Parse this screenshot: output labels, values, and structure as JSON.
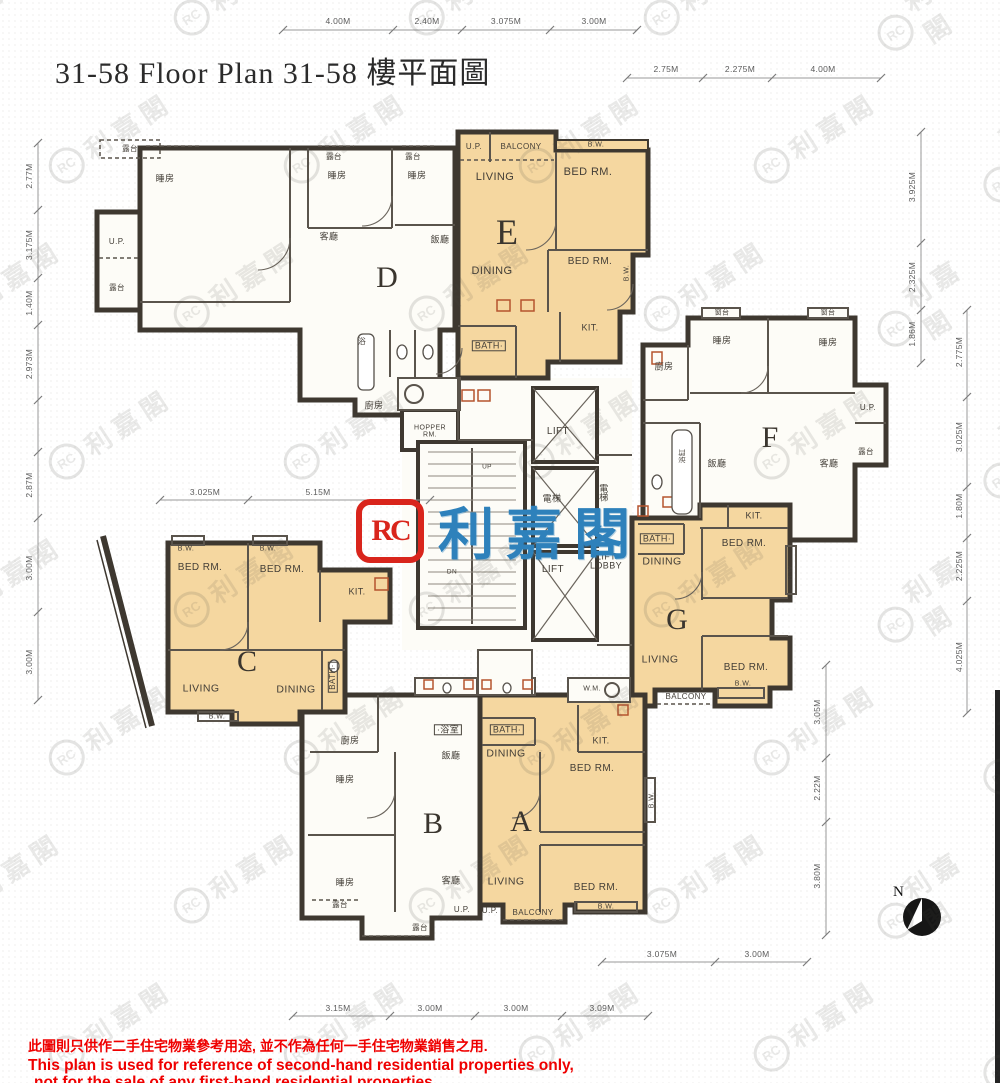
{
  "title": "31-58 Floor Plan 31-58 樓平面圖",
  "logo": {
    "emblem": "RC",
    "name": "利嘉閣"
  },
  "watermark": {
    "emblem": "RC",
    "text": "利嘉閣"
  },
  "north": {
    "label": "N"
  },
  "units": [
    {
      "letter": "D",
      "x": 387,
      "y": 278
    },
    {
      "letter": "E",
      "x": 507,
      "y": 232,
      "s": 36
    },
    {
      "letter": "F",
      "x": 770,
      "y": 438
    },
    {
      "letter": "G",
      "x": 677,
      "y": 620
    },
    {
      "letter": "C",
      "x": 247,
      "y": 662
    },
    {
      "letter": "B",
      "x": 433,
      "y": 824
    },
    {
      "letter": "A",
      "x": 521,
      "y": 822
    }
  ],
  "rooms": [
    {
      "t": "U.P.",
      "x": 474,
      "y": 147,
      "s": 8
    },
    {
      "t": "BALCONY",
      "x": 521,
      "y": 147,
      "s": 8
    },
    {
      "t": "LIVING",
      "x": 495,
      "y": 178,
      "s": 11
    },
    {
      "t": "B.W.",
      "x": 596,
      "y": 145,
      "s": 7
    },
    {
      "t": "BED RM.",
      "x": 588,
      "y": 173,
      "s": 11
    },
    {
      "t": "DINING",
      "x": 492,
      "y": 272,
      "s": 11
    },
    {
      "t": "BED RM.",
      "x": 590,
      "y": 262,
      "s": 10
    },
    {
      "t": "B.W.",
      "x": 627,
      "y": 273,
      "s": 7,
      "r": 1
    },
    {
      "t": "BATH·",
      "x": 489,
      "y": 346,
      "s": 9,
      "box": 1
    },
    {
      "t": "KIT.",
      "x": 590,
      "y": 328,
      "s": 9
    },
    {
      "t": "露台",
      "x": 130,
      "y": 149,
      "s": 7.5
    },
    {
      "t": "睡房",
      "x": 165,
      "y": 179,
      "s": 9
    },
    {
      "t": "露台",
      "x": 334,
      "y": 157,
      "s": 7.5
    },
    {
      "t": "睡房",
      "x": 337,
      "y": 176,
      "s": 9
    },
    {
      "t": "露台",
      "x": 413,
      "y": 157,
      "s": 7.5
    },
    {
      "t": "睡房",
      "x": 417,
      "y": 176,
      "s": 9
    },
    {
      "t": "客廳",
      "x": 329,
      "y": 237,
      "s": 9
    },
    {
      "t": "飯廳",
      "x": 440,
      "y": 240,
      "s": 9
    },
    {
      "t": "U.P.",
      "x": 117,
      "y": 242,
      "s": 8
    },
    {
      "t": "露台",
      "x": 117,
      "y": 288,
      "s": 7.5
    },
    {
      "t": "浴",
      "x": 362,
      "y": 342,
      "s": 8
    },
    {
      "t": "廚房",
      "x": 374,
      "y": 406,
      "s": 9
    },
    {
      "t": "HOPPER RM.",
      "x": 430,
      "y": 432,
      "s": 7,
      "w": 48
    },
    {
      "t": "LIFT",
      "x": 558,
      "y": 432,
      "s": 10
    },
    {
      "t": "電梯",
      "x": 552,
      "y": 499,
      "s": 9
    },
    {
      "t": "電梯",
      "x": 604,
      "y": 494,
      "s": 9,
      "w": 13
    },
    {
      "t": "LIFT",
      "x": 553,
      "y": 570,
      "s": 10
    },
    {
      "t": "LIFT LOBBY",
      "x": 606,
      "y": 562,
      "s": 9,
      "w": 44
    },
    {
      "t": "UP",
      "x": 487,
      "y": 468,
      "s": 6.5
    },
    {
      "t": "DN",
      "x": 452,
      "y": 573,
      "s": 6.5
    },
    {
      "t": "窗台",
      "x": 722,
      "y": 313,
      "s": 7
    },
    {
      "t": "睡房",
      "x": 722,
      "y": 341,
      "s": 9
    },
    {
      "t": "窗台",
      "x": 828,
      "y": 313,
      "s": 7
    },
    {
      "t": "睡房",
      "x": 828,
      "y": 343,
      "s": 9
    },
    {
      "t": "廚房",
      "x": 664,
      "y": 367,
      "s": 9
    },
    {
      "t": "飯廳",
      "x": 717,
      "y": 464,
      "s": 9
    },
    {
      "t": "客廳",
      "x": 829,
      "y": 464,
      "s": 9
    },
    {
      "t": "U.P.",
      "x": 868,
      "y": 408,
      "s": 8
    },
    {
      "t": "露台",
      "x": 866,
      "y": 452,
      "s": 7.5
    },
    {
      "t": "浴缸",
      "x": 683,
      "y": 456,
      "s": 7,
      "r": 1
    },
    {
      "t": "KIT.",
      "x": 754,
      "y": 516,
      "s": 9
    },
    {
      "t": "BATH·",
      "x": 657,
      "y": 539,
      "s": 9,
      "box": 1
    },
    {
      "t": "DINING",
      "x": 662,
      "y": 562,
      "s": 10.5
    },
    {
      "t": "BED RM.",
      "x": 744,
      "y": 544,
      "s": 10
    },
    {
      "t": "B.W.",
      "x": 791,
      "y": 572,
      "s": 7,
      "r": 1
    },
    {
      "t": "LIVING",
      "x": 660,
      "y": 660,
      "s": 10.5
    },
    {
      "t": "BED RM.",
      "x": 746,
      "y": 668,
      "s": 10
    },
    {
      "t": "B.W.",
      "x": 743,
      "y": 684,
      "s": 7
    },
    {
      "t": "BALCONY",
      "x": 686,
      "y": 697,
      "s": 8
    },
    {
      "t": "B.W.",
      "x": 186,
      "y": 549,
      "s": 7
    },
    {
      "t": "B.W.",
      "x": 268,
      "y": 549,
      "s": 7
    },
    {
      "t": "BED RM.",
      "x": 200,
      "y": 568,
      "s": 10
    },
    {
      "t": "BED RM.",
      "x": 282,
      "y": 570,
      "s": 10
    },
    {
      "t": "KIT.",
      "x": 357,
      "y": 592,
      "s": 9
    },
    {
      "t": "LIVING",
      "x": 201,
      "y": 689,
      "s": 10.5
    },
    {
      "t": "DINING",
      "x": 296,
      "y": 690,
      "s": 10.5
    },
    {
      "t": "BATH·",
      "x": 333,
      "y": 677,
      "s": 8,
      "r": 1,
      "box": 1
    },
    {
      "t": "B.W.",
      "x": 217,
      "y": 717,
      "s": 7
    },
    {
      "t": "·浴室",
      "x": 448,
      "y": 730,
      "s": 9,
      "box": 1
    },
    {
      "t": "廚房",
      "x": 350,
      "y": 741,
      "s": 9
    },
    {
      "t": "睡房",
      "x": 345,
      "y": 780,
      "s": 9
    },
    {
      "t": "飯廳",
      "x": 451,
      "y": 756,
      "s": 9
    },
    {
      "t": "睡房",
      "x": 345,
      "y": 883,
      "s": 9
    },
    {
      "t": "客廳",
      "x": 451,
      "y": 881,
      "s": 9
    },
    {
      "t": "露台",
      "x": 340,
      "y": 905,
      "s": 7.5
    },
    {
      "t": "露台",
      "x": 420,
      "y": 928,
      "s": 7.5
    },
    {
      "t": "U.P.",
      "x": 462,
      "y": 910,
      "s": 8
    },
    {
      "t": "W.M.",
      "x": 592,
      "y": 689,
      "s": 7
    },
    {
      "t": "BATH·",
      "x": 507,
      "y": 730,
      "s": 9,
      "box": 1
    },
    {
      "t": "DINING",
      "x": 506,
      "y": 754,
      "s": 10.5
    },
    {
      "t": "KIT.",
      "x": 601,
      "y": 741,
      "s": 9
    },
    {
      "t": "BED RM.",
      "x": 592,
      "y": 769,
      "s": 10
    },
    {
      "t": "B.W.",
      "x": 652,
      "y": 800,
      "s": 7,
      "r": 1
    },
    {
      "t": "LIVING",
      "x": 506,
      "y": 882,
      "s": 10.5
    },
    {
      "t": "BED RM.",
      "x": 596,
      "y": 888,
      "s": 10
    },
    {
      "t": "B.W.",
      "x": 606,
      "y": 907,
      "s": 7
    },
    {
      "t": "U.P.",
      "x": 490,
      "y": 911,
      "s": 8
    },
    {
      "t": "BALCONY",
      "x": 533,
      "y": 913,
      "s": 8
    }
  ],
  "dims": [
    {
      "t": "4.00M",
      "x": 338,
      "y": 21
    },
    {
      "t": "2.40M",
      "x": 427,
      "y": 21
    },
    {
      "t": "3.075M",
      "x": 506,
      "y": 21
    },
    {
      "t": "3.00M",
      "x": 594,
      "y": 21
    },
    {
      "t": "2.75M",
      "x": 666,
      "y": 69
    },
    {
      "t": "2.275M",
      "x": 740,
      "y": 69
    },
    {
      "t": "4.00M",
      "x": 823,
      "y": 69
    },
    {
      "t": "3.925M",
      "x": 912,
      "y": 187,
      "r": 1
    },
    {
      "t": "2.325M",
      "x": 912,
      "y": 277,
      "r": 1
    },
    {
      "t": "1.86M",
      "x": 912,
      "y": 334,
      "r": 1
    },
    {
      "t": "2.775M",
      "x": 959,
      "y": 352,
      "r": 1
    },
    {
      "t": "3.025M",
      "x": 959,
      "y": 437,
      "r": 1
    },
    {
      "t": "1.80M",
      "x": 959,
      "y": 506,
      "r": 1
    },
    {
      "t": "2.225M",
      "x": 959,
      "y": 566,
      "r": 1
    },
    {
      "t": "4.025M",
      "x": 959,
      "y": 657,
      "r": 1
    },
    {
      "t": "3.05M",
      "x": 817,
      "y": 712,
      "r": 1
    },
    {
      "t": "2.22M",
      "x": 817,
      "y": 788,
      "r": 1
    },
    {
      "t": "3.80M",
      "x": 817,
      "y": 876,
      "r": 1
    },
    {
      "t": "2.77M",
      "x": 29,
      "y": 176,
      "r": 1
    },
    {
      "t": "3.175M",
      "x": 29,
      "y": 245,
      "r": 1
    },
    {
      "t": "1.40M",
      "x": 29,
      "y": 303,
      "r": 1
    },
    {
      "t": "2.973M",
      "x": 29,
      "y": 364,
      "r": 1
    },
    {
      "t": "2.87M",
      "x": 29,
      "y": 485,
      "r": 1
    },
    {
      "t": "3.00M",
      "x": 29,
      "y": 568,
      "r": 1
    },
    {
      "t": "3.00M",
      "x": 29,
      "y": 662,
      "r": 1
    },
    {
      "t": "3.025M",
      "x": 205,
      "y": 492
    },
    {
      "t": "5.15M",
      "x": 318,
      "y": 492
    },
    {
      "t": "3.075M",
      "x": 662,
      "y": 954
    },
    {
      "t": "3.00M",
      "x": 757,
      "y": 954
    },
    {
      "t": "3.15M",
      "x": 338,
      "y": 1008
    },
    {
      "t": "3.00M",
      "x": 430,
      "y": 1008
    },
    {
      "t": "3.00M",
      "x": 516,
      "y": 1008
    },
    {
      "t": "3.09M",
      "x": 602,
      "y": 1008
    }
  ],
  "disclaimer": {
    "zh": "此圖則只供作二手住宅物業參考用途, 並不作為任何一手住宅物業銷售之用.",
    "en1": "This plan is used for reference of second-hand residential properties only,",
    "en2": "not for the sale of any first-hand residential properties."
  }
}
